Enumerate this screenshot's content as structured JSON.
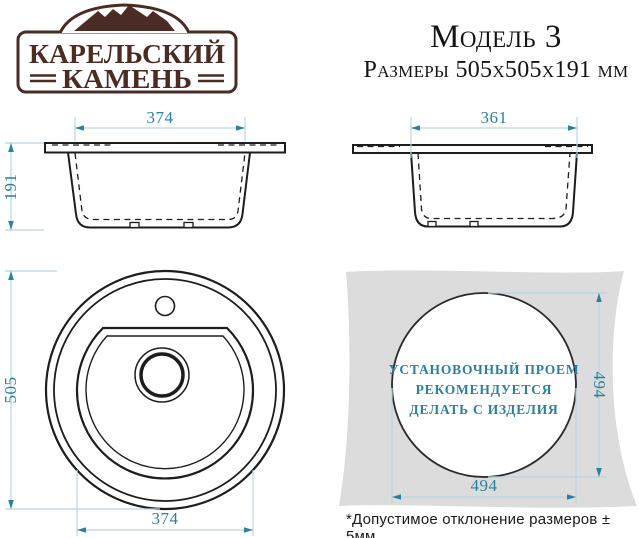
{
  "logo": {
    "line1": "КАРЕЛЬСКИЙ",
    "line2": "КАМЕНЬ"
  },
  "header": {
    "model": "Модель 3",
    "size_line": "Размеры 505х505х191 мм"
  },
  "views": {
    "side_left": {
      "top_width": "374",
      "height": "191"
    },
    "side_right": {
      "top_width": "361"
    },
    "top": {
      "diameter": "505",
      "bowl_width": "374"
    },
    "cutout": {
      "note_line1": "УСТАНОВОЧНЫЙ ПРОЕМ",
      "note_line2": "РЕКОМЕНДУЕТСЯ",
      "note_line3": "ДЕЛАТЬ С ИЗДЕЛИЯ",
      "height": "494",
      "width": "494"
    }
  },
  "footnote": "*Допустимое отклонение размеров ± 5мм",
  "colors": {
    "dimension_accent": "#2a80a2",
    "dimension_line": "#b6d6de",
    "drawing_line": "#1d1d1b",
    "counter_gray": "#dcdcdc",
    "logo_brown": "#4a2c25"
  }
}
